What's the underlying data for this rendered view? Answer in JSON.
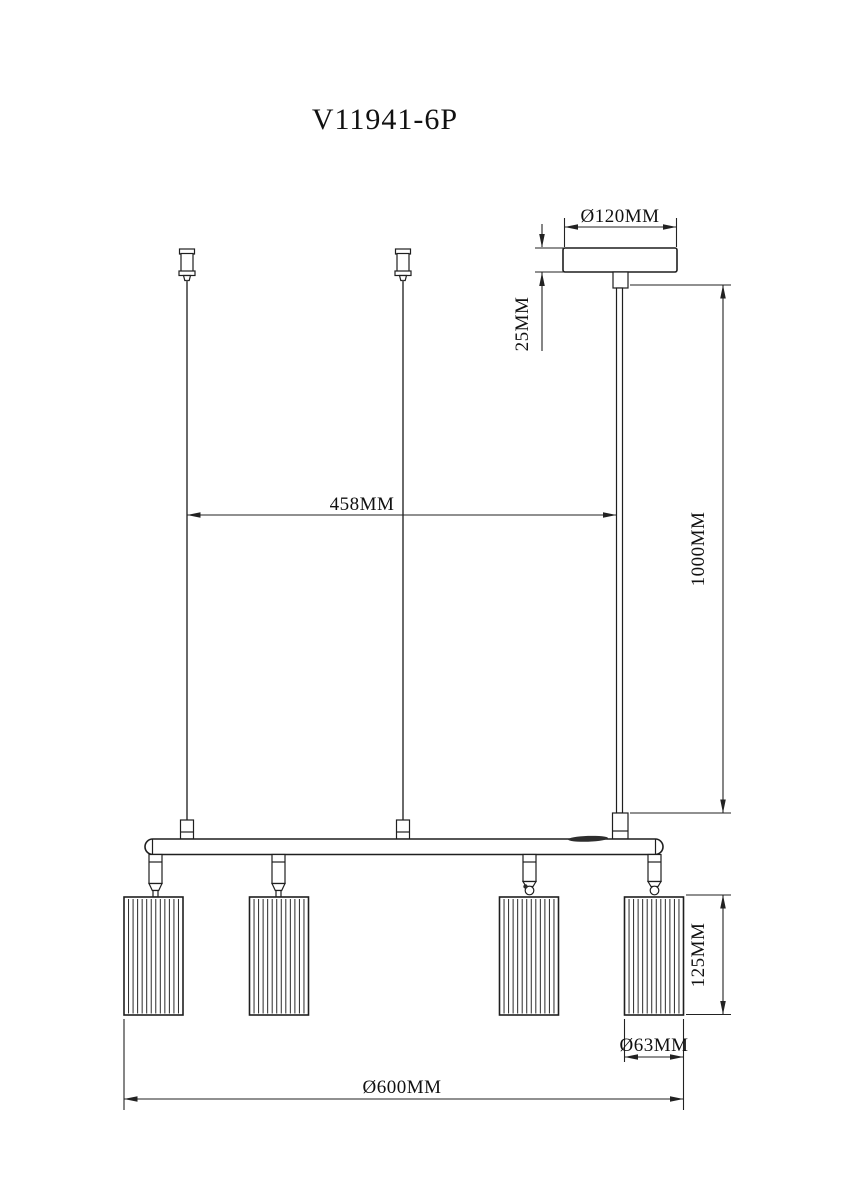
{
  "page": {
    "title": "V11941-6P"
  },
  "drawing": {
    "type": "technical-dimension-drawing",
    "dimensions": {
      "canopy_diameter": "Ø120MM",
      "canopy_height": "25MM",
      "suspension_spacing": "458MM",
      "drop_length": "1000MM",
      "shade_height": "125MM",
      "shade_diameter": "Ø63MM",
      "overall_diameter": "Ø600MM"
    },
    "colors": {
      "line": "#1f1f1f",
      "dimension_line": "#222222",
      "wire": "#5a5a5a",
      "switch": "#2d2d2d",
      "background": "#ffffff"
    }
  }
}
